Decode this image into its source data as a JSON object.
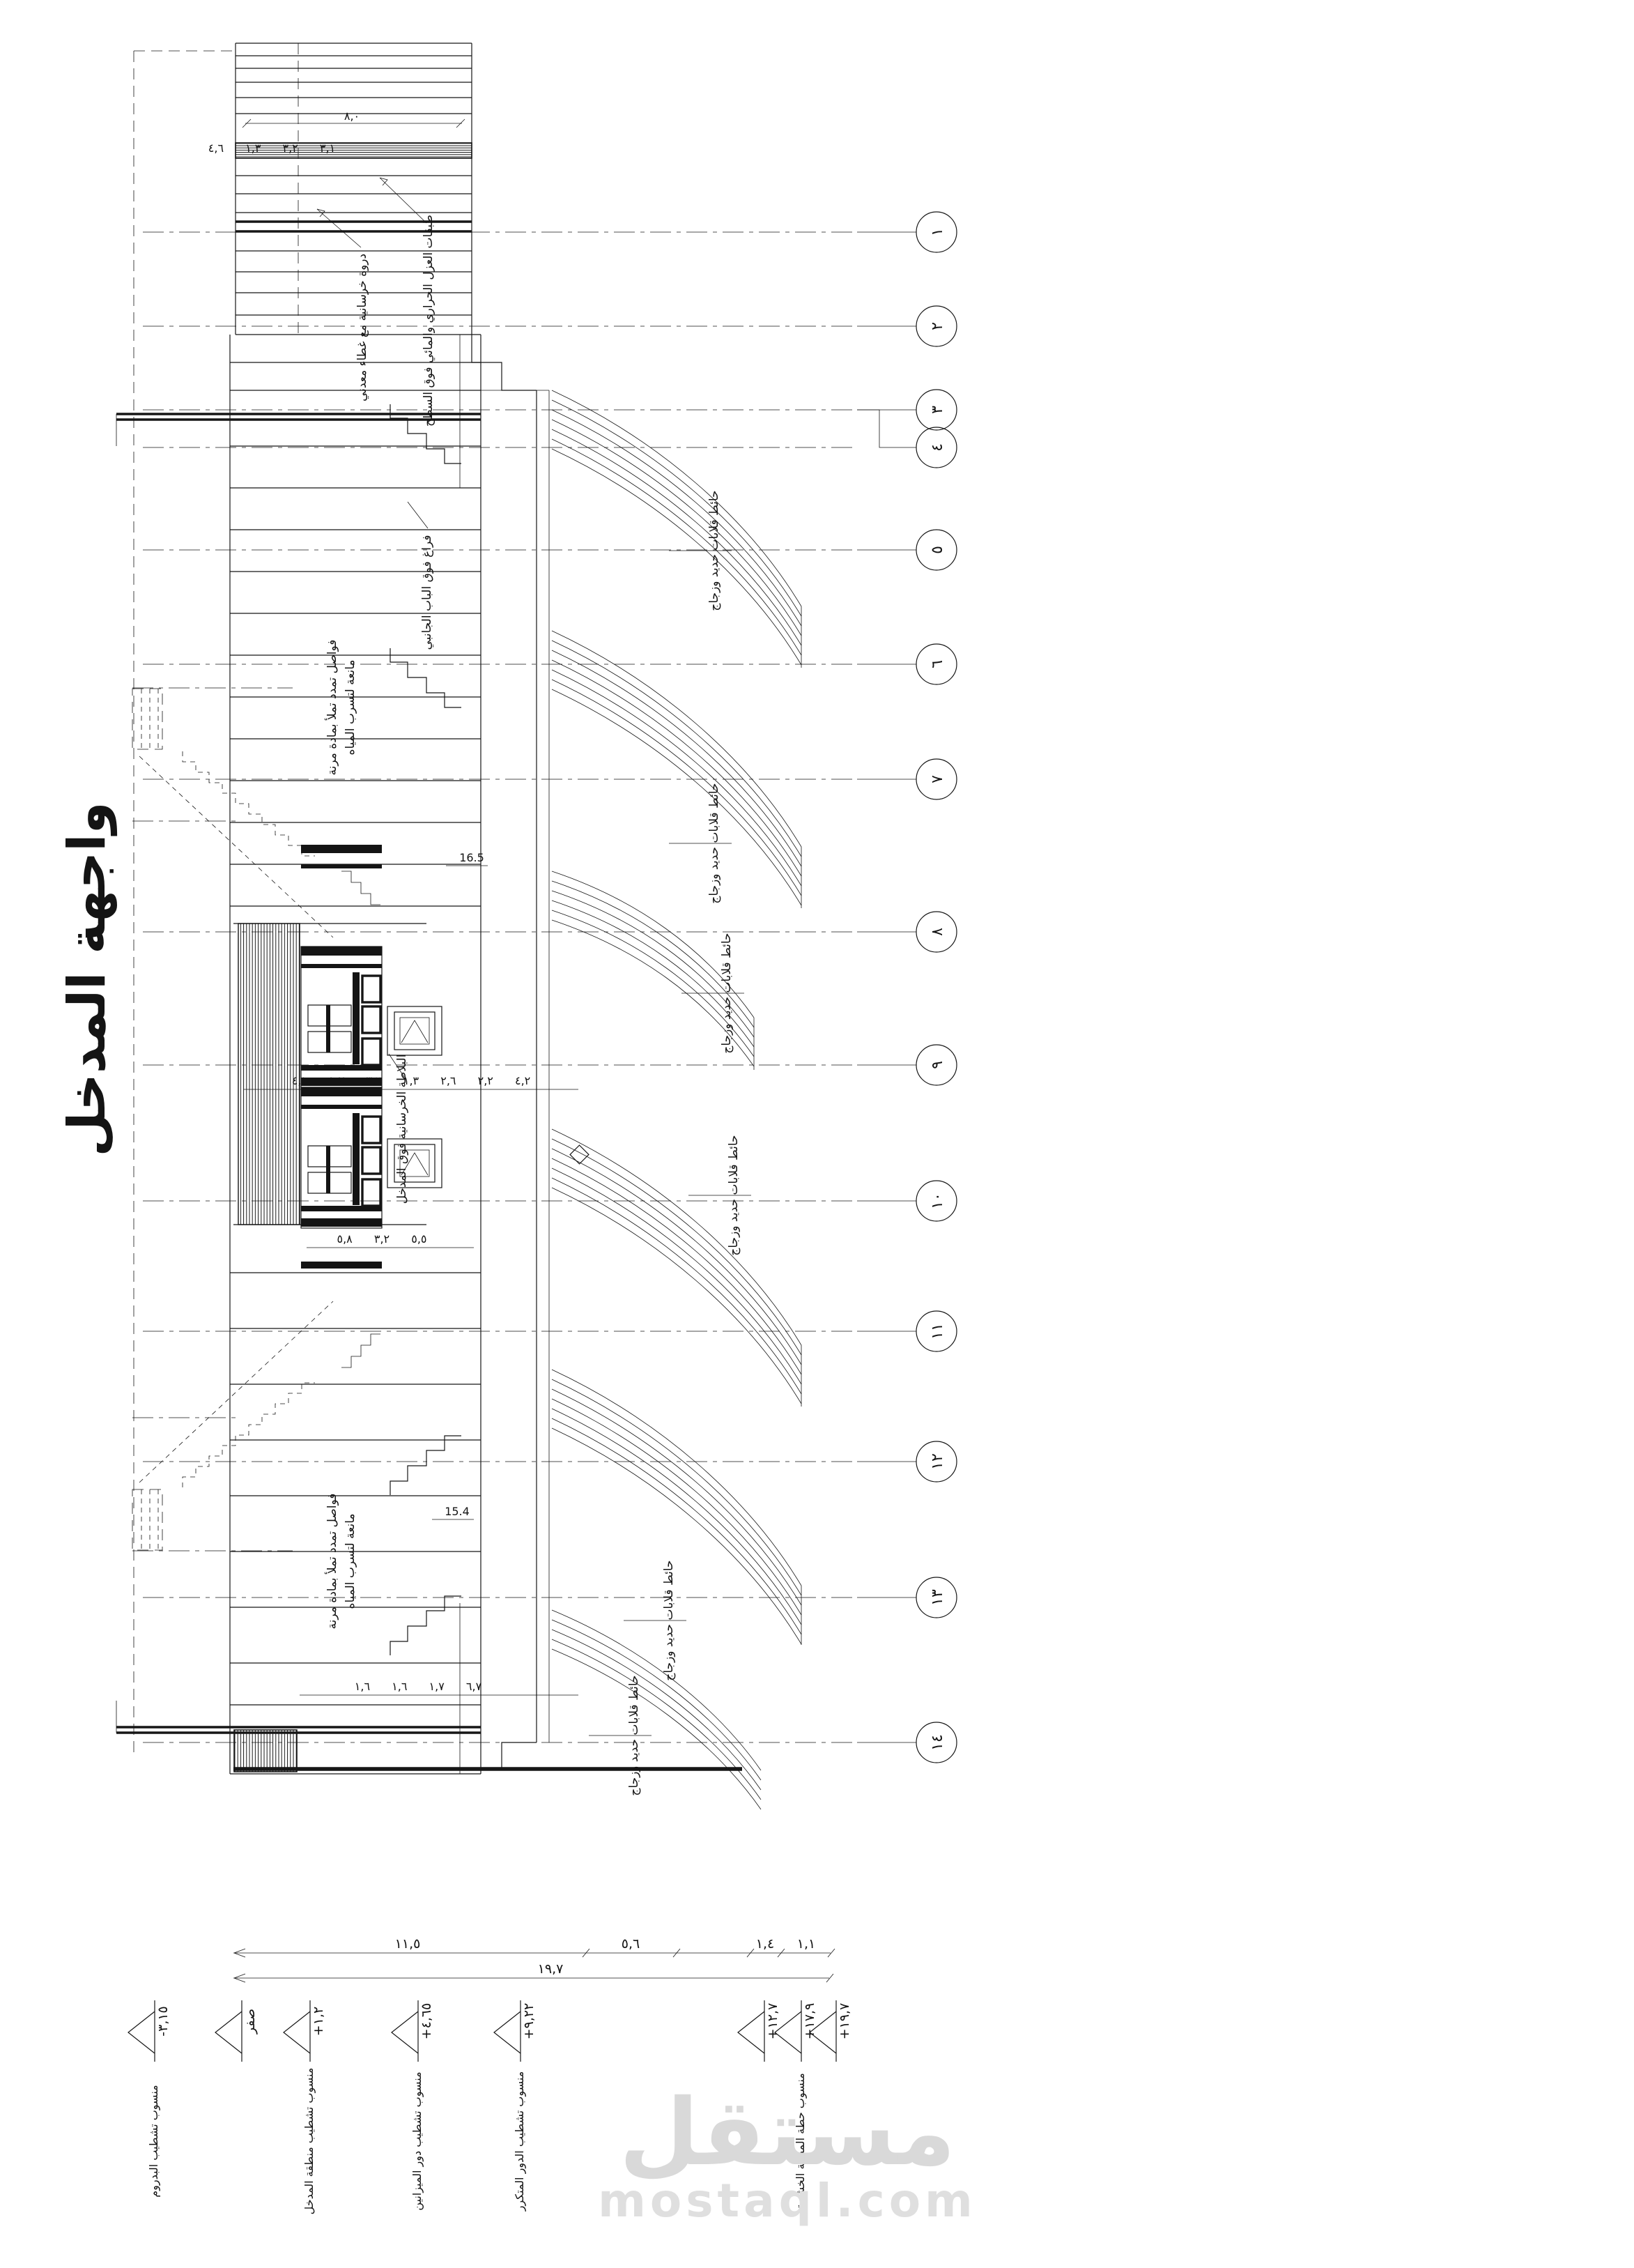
{
  "sheet": {
    "title": "واجهة المدخل",
    "background": "#ffffff",
    "line_color": "#161616"
  },
  "watermark": {
    "logo": "مستقل",
    "domain": "mostaql.com",
    "color": "#d9d9d9"
  },
  "grid": {
    "bubbles": [
      "١",
      "٢",
      "٣",
      "٤",
      "٥",
      "٦",
      "٧",
      "٨",
      "٩",
      "١٠",
      "١١",
      "١٢",
      "١٣",
      "١٤"
    ]
  },
  "levels": {
    "markers": [
      {
        "value": "-٣,١٥",
        "desc": "منسوب تشطيب البدروم"
      },
      {
        "value": "صفر",
        "desc": ""
      },
      {
        "value": "+١,٢",
        "desc": "منسوب تشطيب منطقة المدخل"
      },
      {
        "value": "+٤,٦٥",
        "desc": "منسوب تشطيب دور الميزانين"
      },
      {
        "value": "+٩,٢٢",
        "desc": "منسوب تشطيب الدور المتكرر"
      },
      {
        "value": "+١٢,٧",
        "desc": ""
      },
      {
        "value": "+١٧,٩",
        "desc": "منسوب حطة المظلة الخشبية"
      },
      {
        "value": "+١٩,٧",
        "desc": ""
      }
    ]
  },
  "dimensions": {
    "overall_width": "١٩,٧",
    "row1": {
      "d1": "١١,٥",
      "d2": "٥,٦",
      "d3": "١,٤",
      "d4": "١,١"
    },
    "tower_width": "٨,٠",
    "top_chain": "٣,١ ٣,٢ ١,٣ ٤,٦",
    "portal_chain": "٤,٢ ٢,٢ ٢,٦ ١,٣ ٣,٦ ١,٧ ٤,١",
    "portal_chain2": "٥,٥ ٣,٢ ٥,٨",
    "lower_chain": "٦,٧ ١,٧ ١,٦ ١,٦",
    "level_mid": "16.5",
    "level_low": "15.4"
  },
  "annotations": {
    "roof_insulation": "طبقات العزل الحراري والمائي فوق السطح",
    "parapet_cladding": "دروة خرسانية مع غطاء معدني",
    "side_door_void": "فراغ فوق الباب الجانبي",
    "entrance_slab": "البلاطة الخرسانية فوق المدخل",
    "expansion_joint_1": "فواصل تمدد تملأ بمادة مرنة",
    "expansion_joint_2": "مانعة لتسرب المياه",
    "louver_wall": "حائط قلابات حديد وزجاج"
  }
}
